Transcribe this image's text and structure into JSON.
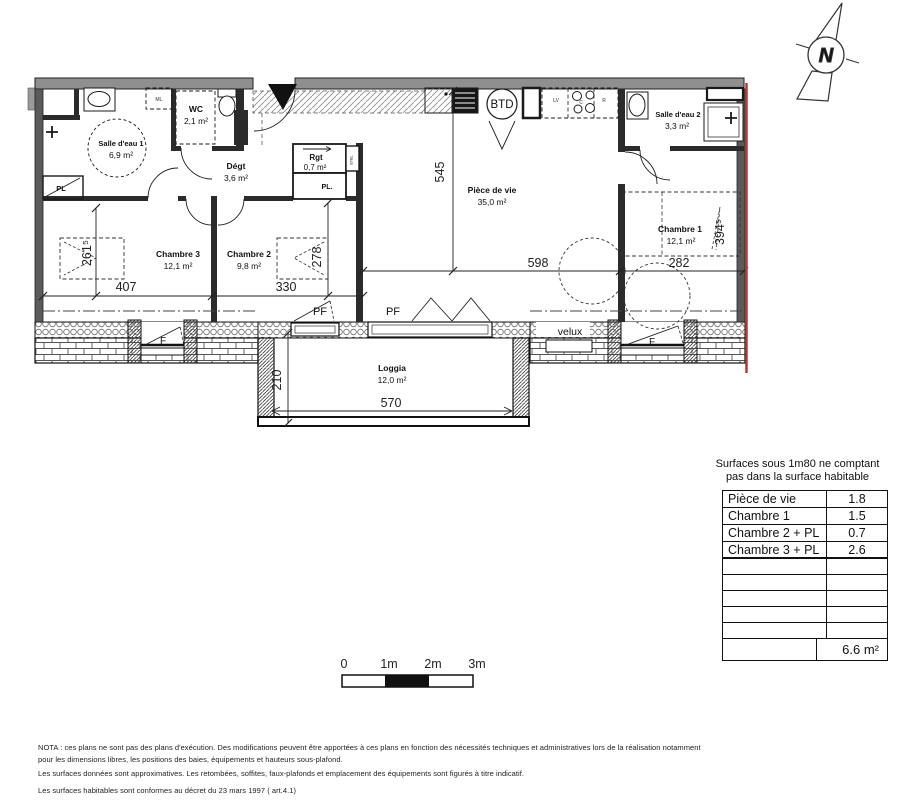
{
  "compass": {
    "north": "N"
  },
  "rooms": {
    "salle_eau_1": {
      "name": "Salle d'eau 1",
      "area": "6,9 m²"
    },
    "wc": {
      "name": "WC",
      "area": "2,1 m²"
    },
    "degt": {
      "name": "Dégt",
      "area": "3,6 m²"
    },
    "rgt": {
      "name": "Rgt",
      "area": "0,7 m²"
    },
    "chambre_3": {
      "name": "Chambre 3",
      "area": "12,1 m²"
    },
    "chambre_2": {
      "name": "Chambre 2",
      "area": "9,8 m²"
    },
    "piece_de_vie": {
      "name": "Pièce de vie",
      "area": "35,0 m²"
    },
    "salle_eau_2": {
      "name": "Salle d'eau 2",
      "area": "3,3 m²"
    },
    "chambre_1": {
      "name": "Chambre 1",
      "area": "12,1 m²"
    },
    "loggia": {
      "name": "Loggia",
      "area": "12,0 m²"
    }
  },
  "fixtures": {
    "btd": "BTD",
    "ml": "ML",
    "lv": "LV",
    "cooktop": "C",
    "fridge": "R",
    "etel": "ETEL",
    "pl_salle_eau": "PL",
    "pl_hall": "PL.",
    "velux": "velux",
    "pf_chambre2": "PF",
    "pf_sejour": "PF",
    "f_chambre3": "F",
    "f_chambre1": "F"
  },
  "dims": {
    "d407": "407",
    "d330": "330",
    "d598": "598",
    "d282": "282",
    "d545": "545",
    "d2615": "261⁵",
    "d278": "278",
    "d3945": "394⁵",
    "d210": "210",
    "d570": "570"
  },
  "surface_table": {
    "title_line1": "Surfaces sous 1m80 ne comptant",
    "title_line2": "pas dans la surface habitable",
    "rows": [
      {
        "label": "Pièce de vie",
        "value": "1.8"
      },
      {
        "label": "Chambre 1",
        "value": "1.5"
      },
      {
        "label": "Chambre 2 + PL",
        "value": "0.7"
      },
      {
        "label": "Chambre 3 + PL",
        "value": "2.6"
      }
    ],
    "total": "6.6 m²"
  },
  "scale_bar": {
    "t0": "0",
    "t1": "1m",
    "t2": "2m",
    "t3": "3m"
  },
  "notes": {
    "line1": "NOTA : ces plans ne sont pas des plans d'exécution. Des modifications peuvent être apportées à ces plans en fonction des nécessités techniques et administratives lors de la réalisation notamment",
    "line2": "pour les dimensions libres, les positions des baies, équipements et hauteurs sous-plafond.",
    "line3": "Les surfaces données sont approximatives. Les retombées, soffites, faux-plafonds et emplacement des équipements sont figurés à titre indicatif.",
    "line4": "Les surfaces habitables sont conformes au décret du 23 mars 1997 ( art.4.1)"
  },
  "colors": {
    "wall_gray": "#8f8f8f",
    "line": "#1a1a1a",
    "boundary_red": "#b23b36"
  }
}
